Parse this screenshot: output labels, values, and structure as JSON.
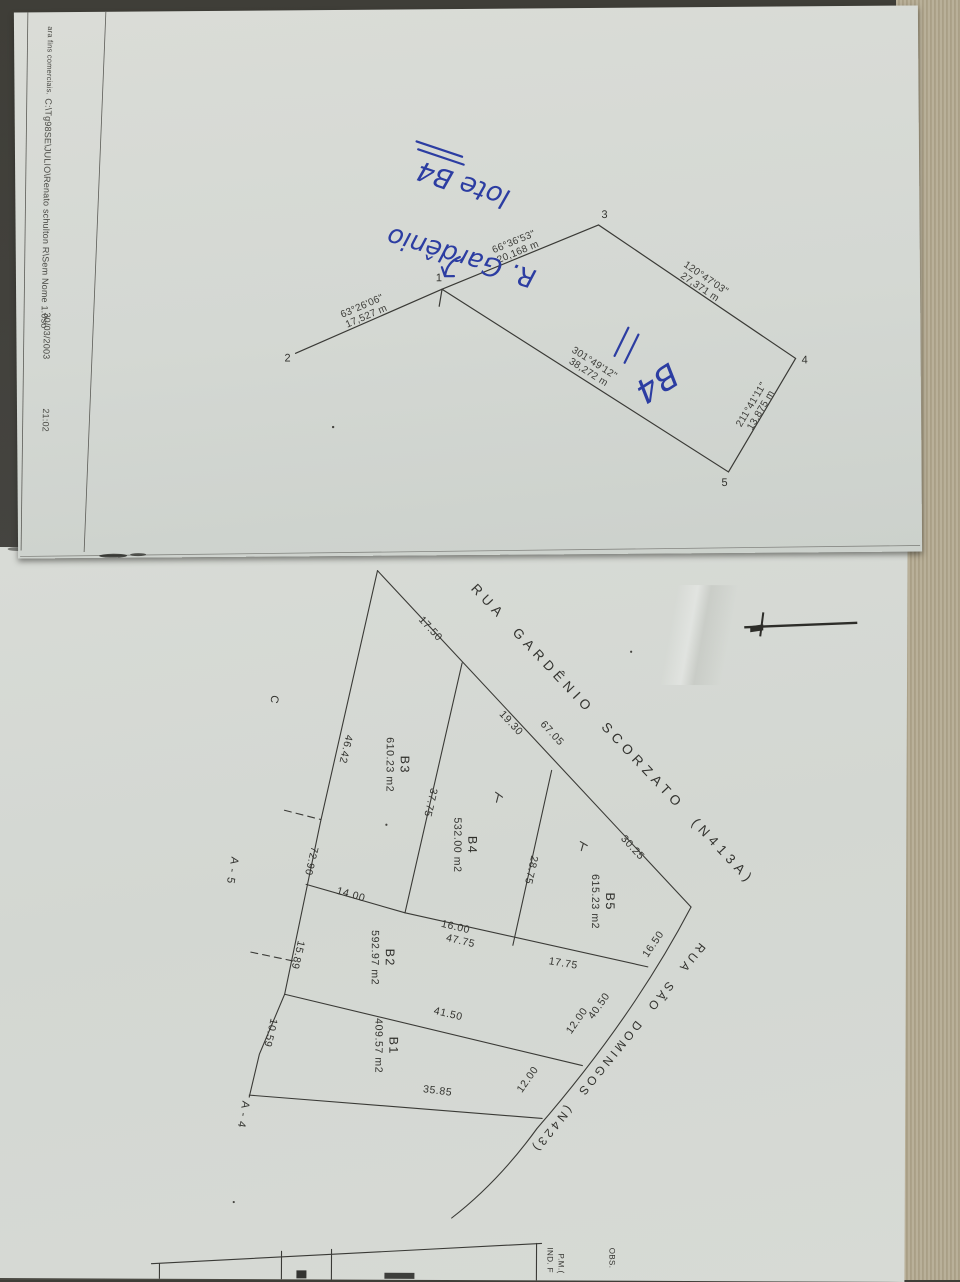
{
  "photo": {
    "desk_color": "#45443e",
    "paper_color": "#d6dad5"
  },
  "sheet1": {
    "margin": {
      "notice": "ara fins comerciais.",
      "file_path": "C:\\Tg98SE\\JULIO\\Renato schulton R\\Sem Nome 1.0so",
      "date": "30/03/2003",
      "time": "21:02"
    },
    "handwriting": {
      "lot_note": "lote B4",
      "street_note": "R. Gardênio",
      "lot_mark": "B4"
    },
    "survey": {
      "vertices": {
        "v1": "1",
        "v2": "2",
        "v3": "3",
        "v4": "4",
        "v5": "5"
      },
      "edges": {
        "e21": {
          "bearing": "63°26'06\"",
          "distance": "17,527 m"
        },
        "e13": {
          "bearing": "66°36'53\"",
          "distance": "20,168 m"
        },
        "e34": {
          "bearing": "120°47'03\"",
          "distance": "27,371 m"
        },
        "e45": {
          "bearing": "211°41'11\"",
          "distance": "13,875 m"
        },
        "e51": {
          "bearing": "301°49'12\"",
          "distance": "38,272 m"
        }
      }
    }
  },
  "sheet2": {
    "streets": {
      "gardenio": "RUA GARDÊNIO SCORZATO (N413A)",
      "domingos": "RUA SÃO DOMINGOS (N423)"
    },
    "lots": {
      "b1": {
        "name": "B1",
        "area": "409.57 m2"
      },
      "b2": {
        "name": "B2",
        "area": "592.97 m2"
      },
      "b3": {
        "name": "B3",
        "area": "610.23 m2"
      },
      "b4": {
        "name": "B4",
        "area": "532.00 m2"
      },
      "b5": {
        "name": "B5",
        "area": "615.23 m2"
      }
    },
    "dimensions": {
      "front_a": "17.50",
      "front_b": "19.30",
      "front_c": "67.05",
      "front_d": "30.25",
      "divider_b3_b4": "37.75",
      "divider_b4_b5": "28.75",
      "left_a": "46.42",
      "left_b": "72.90",
      "left_c": "15.89",
      "left_d": "10.59",
      "b2_left": "14.00",
      "b2_front_a": "16.00",
      "b2_front_b": "47.75",
      "b5_south": "17.75",
      "street_a": "16.50",
      "street_b": "40.50",
      "street_c": "12.00",
      "street_d": "12.00",
      "b1_north": "41.50",
      "b1_south": "35.85"
    },
    "neighbors": {
      "c": "C",
      "a5": "A - 5",
      "a4": "A - 4"
    },
    "title_block": {
      "ind": "IND. F",
      "pm": "P.M.(",
      "obs": "OBS."
    }
  }
}
